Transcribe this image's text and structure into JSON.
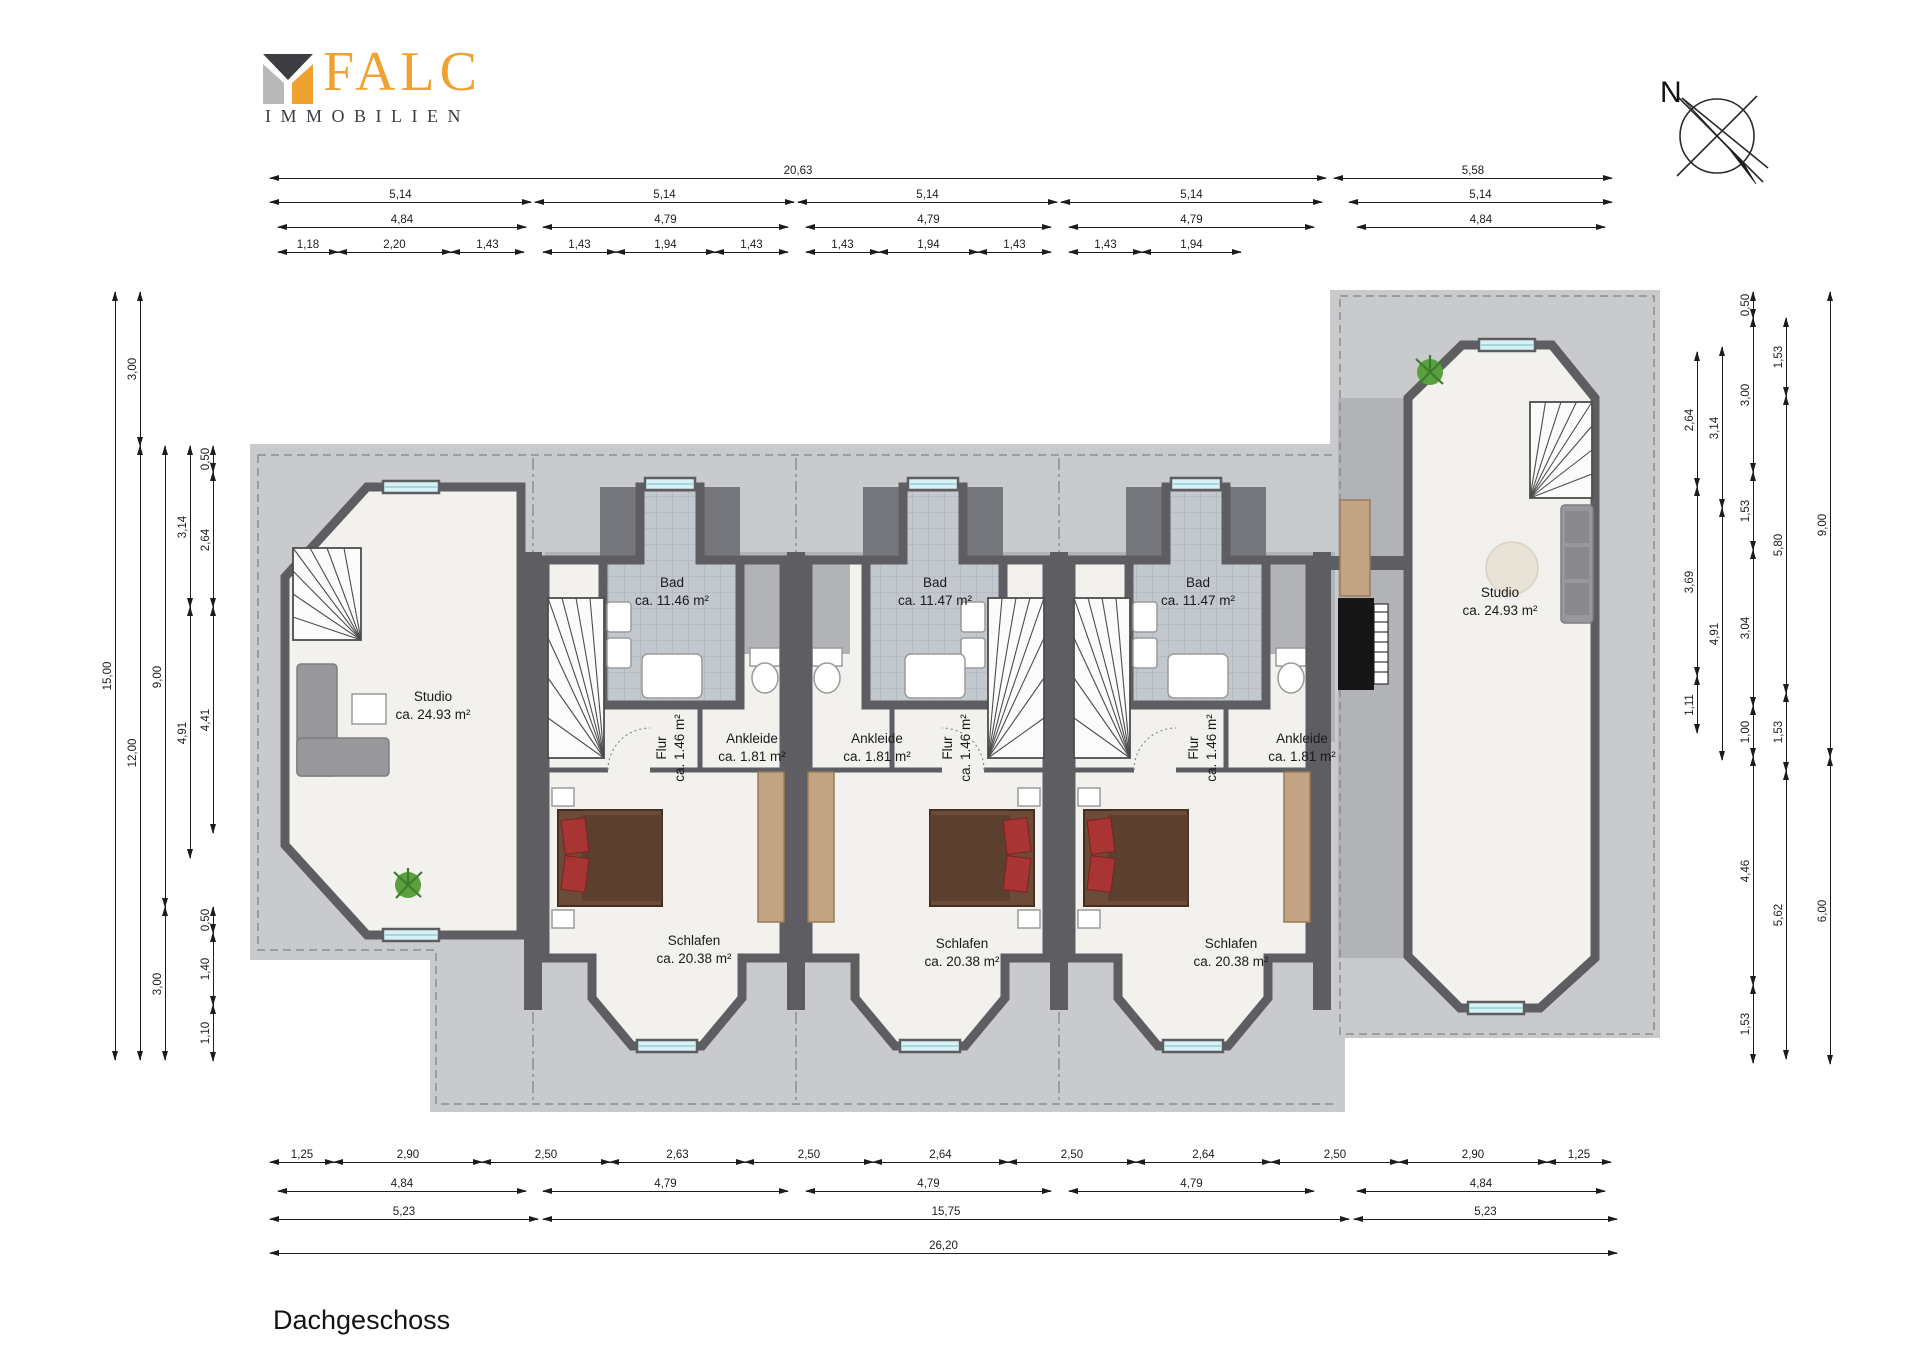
{
  "header": {
    "brand": "FALC",
    "brand_sub": "IMMOBILIEN"
  },
  "compass": {
    "label": "N"
  },
  "floor_title": "Dachgeschoss",
  "colors": {
    "wall": "#5d5d62",
    "roof_light": "#c9cacb",
    "roof_mid": "#b2b3b6",
    "floor": "#f2f1ed",
    "tile": "#c3c8cf",
    "window": "#d8f1f5",
    "wood": "#c2a484",
    "bed": "#6a4c38",
    "pillow": "#a83434",
    "sofa": "#98989a",
    "plant": "#5aa03e",
    "logo_orange": "#f0a231",
    "logo_dark": "#3c3c42",
    "logo_gray": "#b9b9bb"
  },
  "rooms": [
    {
      "name": "Studio",
      "area": "ca. 24.93 m²",
      "x": 433,
      "y": 706,
      "rot": false
    },
    {
      "name": "Bad",
      "area": "ca. 11.46 m²",
      "x": 672,
      "y": 592,
      "rot": false
    },
    {
      "name": "Bad",
      "area": "ca. 11.47 m²",
      "x": 935,
      "y": 592,
      "rot": false
    },
    {
      "name": "Bad",
      "area": "ca. 11.47 m²",
      "x": 1198,
      "y": 592,
      "rot": false
    },
    {
      "name": "Flur",
      "area": "ca. 1.46 m²",
      "x": 671,
      "y": 748,
      "rot": true
    },
    {
      "name": "Ankleide",
      "area": "ca. 1.81 m²",
      "x": 752,
      "y": 748,
      "rot": false
    },
    {
      "name": "Ankleide",
      "area": "ca. 1.81 m²",
      "x": 877,
      "y": 748,
      "rot": false
    },
    {
      "name": "Flur",
      "area": "ca. 1.46 m²",
      "x": 957,
      "y": 748,
      "rot": true
    },
    {
      "name": "Flur",
      "area": "ca. 1.46 m²",
      "x": 1203,
      "y": 748,
      "rot": true
    },
    {
      "name": "Ankleide",
      "area": "ca. 1.81 m²",
      "x": 1302,
      "y": 748,
      "rot": false
    },
    {
      "name": "Schlafen",
      "area": "ca. 20.38 m²",
      "x": 694,
      "y": 950,
      "rot": false
    },
    {
      "name": "Schlafen",
      "area": "ca. 20.38 m²",
      "x": 962,
      "y": 953,
      "rot": false
    },
    {
      "name": "Schlafen",
      "area": "ca. 20.38 m²",
      "x": 1231,
      "y": 953,
      "rot": false
    },
    {
      "name": "Studio",
      "area": "ca. 24.93 m²",
      "x": 1500,
      "y": 602,
      "rot": false
    }
  ],
  "dimensions": {
    "horizontal": [
      {
        "t": "20,63",
        "x1": 270,
        "x2": 1326,
        "y": 178
      },
      {
        "t": "5,58",
        "x1": 1334,
        "x2": 1612,
        "y": 178
      },
      {
        "t": "5,14",
        "x1": 270,
        "x2": 531,
        "y": 202
      },
      {
        "t": "5,14",
        "x1": 535,
        "x2": 794,
        "y": 202
      },
      {
        "t": "5,14",
        "x1": 798,
        "x2": 1057,
        "y": 202
      },
      {
        "t": "5,14",
        "x1": 1061,
        "x2": 1322,
        "y": 202
      },
      {
        "t": "5,14",
        "x1": 1349,
        "x2": 1612,
        "y": 202
      },
      {
        "t": "4,84",
        "x1": 278,
        "x2": 526,
        "y": 227
      },
      {
        "t": "4,79",
        "x1": 543,
        "x2": 788,
        "y": 227
      },
      {
        "t": "4,79",
        "x1": 806,
        "x2": 1051,
        "y": 227
      },
      {
        "t": "4,79",
        "x1": 1069,
        "x2": 1314,
        "y": 227
      },
      {
        "t": "4,84",
        "x1": 1357,
        "x2": 1605,
        "y": 227
      },
      {
        "t": "1,18",
        "x1": 278,
        "x2": 338,
        "y": 252
      },
      {
        "t": "2,20",
        "x1": 338,
        "x2": 451,
        "y": 252
      },
      {
        "t": "1,43",
        "x1": 451,
        "x2": 524,
        "y": 252
      },
      {
        "t": "1,43",
        "x1": 543,
        "x2": 616,
        "y": 252
      },
      {
        "t": "1,94",
        "x1": 616,
        "x2": 715,
        "y": 252
      },
      {
        "t": "1,43",
        "x1": 715,
        "x2": 788,
        "y": 252
      },
      {
        "t": "1,43",
        "x1": 806,
        "x2": 879,
        "y": 252
      },
      {
        "t": "1,94",
        "x1": 879,
        "x2": 978,
        "y": 252
      },
      {
        "t": "1,43",
        "x1": 978,
        "x2": 1051,
        "y": 252
      },
      {
        "t": "1,43",
        "x1": 1069,
        "x2": 1142,
        "y": 252
      },
      {
        "t": "1,94",
        "x1": 1142,
        "x2": 1241,
        "y": 252
      },
      {
        "t": "1,25",
        "x1": 270,
        "x2": 334,
        "y": 1162
      },
      {
        "t": "2,90",
        "x1": 334,
        "x2": 482,
        "y": 1162
      },
      {
        "t": "2,50",
        "x1": 482,
        "x2": 610,
        "y": 1162
      },
      {
        "t": "2,63",
        "x1": 610,
        "x2": 745,
        "y": 1162
      },
      {
        "t": "2,50",
        "x1": 745,
        "x2": 873,
        "y": 1162
      },
      {
        "t": "2,64",
        "x1": 873,
        "x2": 1008,
        "y": 1162
      },
      {
        "t": "2,50",
        "x1": 1008,
        "x2": 1136,
        "y": 1162
      },
      {
        "t": "2,64",
        "x1": 1136,
        "x2": 1271,
        "y": 1162
      },
      {
        "t": "2,50",
        "x1": 1271,
        "x2": 1399,
        "y": 1162
      },
      {
        "t": "2,90",
        "x1": 1399,
        "x2": 1547,
        "y": 1162
      },
      {
        "t": "1,25",
        "x1": 1547,
        "x2": 1611,
        "y": 1162
      },
      {
        "t": "4,84",
        "x1": 278,
        "x2": 526,
        "y": 1191
      },
      {
        "t": "4,79",
        "x1": 543,
        "x2": 788,
        "y": 1191
      },
      {
        "t": "4,79",
        "x1": 806,
        "x2": 1051,
        "y": 1191
      },
      {
        "t": "4,79",
        "x1": 1069,
        "x2": 1314,
        "y": 1191
      },
      {
        "t": "4,84",
        "x1": 1357,
        "x2": 1605,
        "y": 1191
      },
      {
        "t": "5,23",
        "x1": 270,
        "x2": 538,
        "y": 1219
      },
      {
        "t": "15,75",
        "x1": 543,
        "x2": 1349,
        "y": 1219
      },
      {
        "t": "5,23",
        "x1": 1354,
        "x2": 1617,
        "y": 1219
      },
      {
        "t": "26,20",
        "x1": 270,
        "x2": 1617,
        "y": 1253
      }
    ],
    "vertical": [
      {
        "t": "15,00",
        "y1": 292,
        "y2": 1060,
        "x": 115
      },
      {
        "t": "3,00",
        "y1": 292,
        "y2": 446,
        "x": 140
      },
      {
        "t": "12,00",
        "y1": 446,
        "y2": 1060,
        "x": 140
      },
      {
        "t": "9,00",
        "y1": 446,
        "y2": 907,
        "x": 165
      },
      {
        "t": "3,00",
        "y1": 907,
        "y2": 1060,
        "x": 165
      },
      {
        "t": "3,14",
        "y1": 446,
        "y2": 607,
        "x": 190
      },
      {
        "t": "4,91",
        "y1": 607,
        "y2": 858,
        "x": 190
      },
      {
        "t": "0,50",
        "y1": 446,
        "y2": 472,
        "x": 213
      },
      {
        "t": "2,64",
        "y1": 472,
        "y2": 607,
        "x": 213
      },
      {
        "t": "4,41",
        "y1": 607,
        "y2": 833,
        "x": 213
      },
      {
        "t": "0,50",
        "y1": 907,
        "y2": 933,
        "x": 213
      },
      {
        "t": "1,40",
        "y1": 933,
        "y2": 1005,
        "x": 213
      },
      {
        "t": "1,10",
        "y1": 1005,
        "y2": 1061,
        "x": 213
      },
      {
        "t": "2,64",
        "y1": 352,
        "y2": 487,
        "x": 1697
      },
      {
        "t": "3,69",
        "y1": 487,
        "y2": 676,
        "x": 1697
      },
      {
        "t": "1,11",
        "y1": 676,
        "y2": 733,
        "x": 1697
      },
      {
        "t": "3,14",
        "y1": 347,
        "y2": 508,
        "x": 1722
      },
      {
        "t": "4,91",
        "y1": 508,
        "y2": 760,
        "x": 1722
      },
      {
        "t": "0,50",
        "y1": 292,
        "y2": 318,
        "x": 1753
      },
      {
        "t": "3,00",
        "y1": 318,
        "y2": 472,
        "x": 1753
      },
      {
        "t": "1,53",
        "y1": 472,
        "y2": 550,
        "x": 1753
      },
      {
        "t": "3,04",
        "y1": 550,
        "y2": 706,
        "x": 1753
      },
      {
        "t": "1,00",
        "y1": 706,
        "y2": 757,
        "x": 1753
      },
      {
        "t": "4,46",
        "y1": 757,
        "y2": 985,
        "x": 1753
      },
      {
        "t": "1,53",
        "y1": 985,
        "y2": 1063,
        "x": 1753
      },
      {
        "t": "1,53",
        "y1": 318,
        "y2": 396,
        "x": 1786
      },
      {
        "t": "5,80",
        "y1": 396,
        "y2": 693,
        "x": 1786
      },
      {
        "t": "1,53",
        "y1": 693,
        "y2": 771,
        "x": 1786
      },
      {
        "t": "5,62",
        "y1": 771,
        "y2": 1059,
        "x": 1786
      },
      {
        "t": "9,00",
        "y1": 292,
        "y2": 757,
        "x": 1830
      },
      {
        "t": "6,00",
        "y1": 757,
        "y2": 1064,
        "x": 1830
      }
    ]
  }
}
